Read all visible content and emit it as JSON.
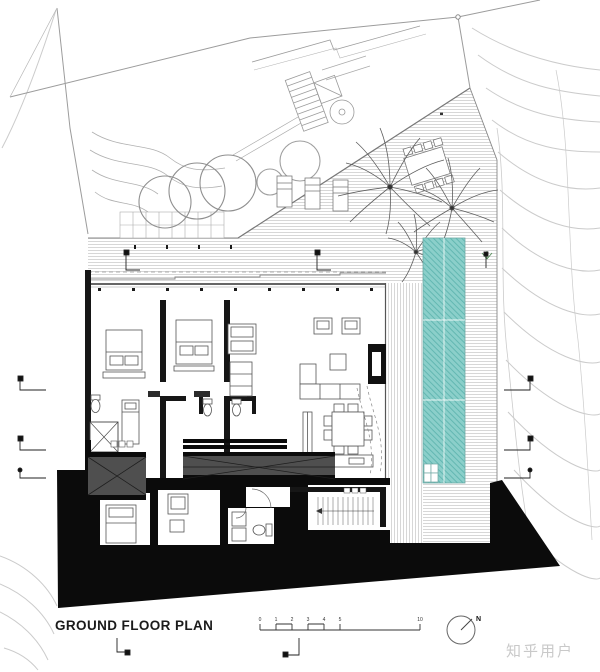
{
  "canvas": {
    "width": 600,
    "height": 672,
    "background": "#ffffff"
  },
  "footer": {
    "title": "GROUND FLOOR PLAN",
    "scale_bar": {
      "labels": [
        "0",
        "1",
        "2",
        "3",
        "4",
        "5",
        "10"
      ]
    },
    "north_label": "N",
    "watermark": "知乎用户"
  },
  "colors": {
    "pool_fill": "#8bcfca",
    "pool_hatch": "#5fb5af",
    "poche_black": "#0b0b0b",
    "deck_hatch": "#c6c6c6",
    "contour_line": "#cbcbcb",
    "garden_line": "#9c9c9c",
    "wall_line": "#161616",
    "furniture_line": "#555555",
    "gray_deck": "#4f4f4f",
    "watermark": "#c9c9c9"
  },
  "icon_names": [
    "north-arrow-icon",
    "scale-bar",
    "swimming-pool",
    "pool-steps",
    "palm-tree-icon",
    "lounge-chair",
    "outdoor-dining-table",
    "tree-canopy",
    "garden-stairs",
    "section-marker",
    "bed",
    "sofa",
    "dining-table",
    "toilet",
    "fireplace",
    "stairs"
  ]
}
